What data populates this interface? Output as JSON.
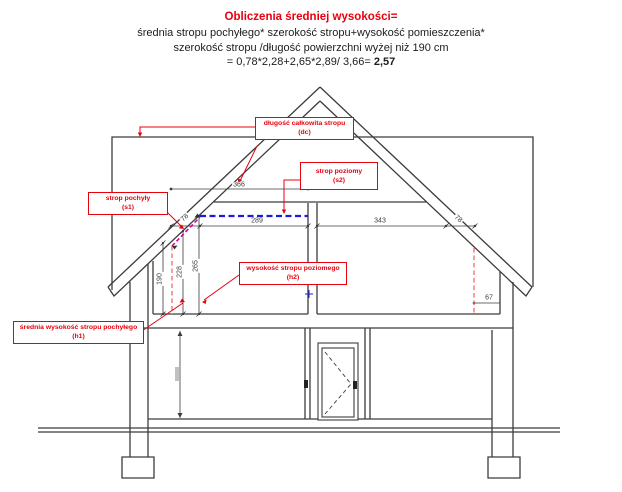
{
  "title": {
    "heading": "Obliczenia średniej wysokości=",
    "line2": "średnia stropu pochyłego* szerokość stropu+wysokość pomieszczenia*",
    "line3": "szerokość stropu /długość powierzchni wyżej niż 190 cm",
    "formula_prefix": "= 0,78*2,28+2,65*2,89/ 3,66= ",
    "formula_result": "2,57"
  },
  "labels": {
    "dc": {
      "line1": "długość całkowita stropu",
      "line2": "(dc)"
    },
    "s2": {
      "line1": "strop poziomy",
      "line2": "(s2)"
    },
    "s1": {
      "line1": "strop pochyły",
      "line2": "(s1)"
    },
    "h2": {
      "line1": "wysokość stropu poziomego",
      "line2": "(h2)"
    },
    "h1": {
      "line1": "średnia wysokość stropu pochyłego",
      "line2": "(h1)"
    }
  },
  "dimensions": {
    "total_length": "366",
    "sloped_width_left": "78",
    "flat_width": "289",
    "right_flat_width": "343",
    "sloped_width_right": "78",
    "height_190": "190",
    "height_228": "228",
    "height_265": "265",
    "right_offset": "67"
  },
  "colors": {
    "accent_red": "#e8000d",
    "line_black": "#3c3c3c",
    "flat_ceiling_blue": "#1a1adf",
    "sloped_ceiling_magenta": "#d6009e",
    "height_marker_red": "#f26b6b"
  }
}
